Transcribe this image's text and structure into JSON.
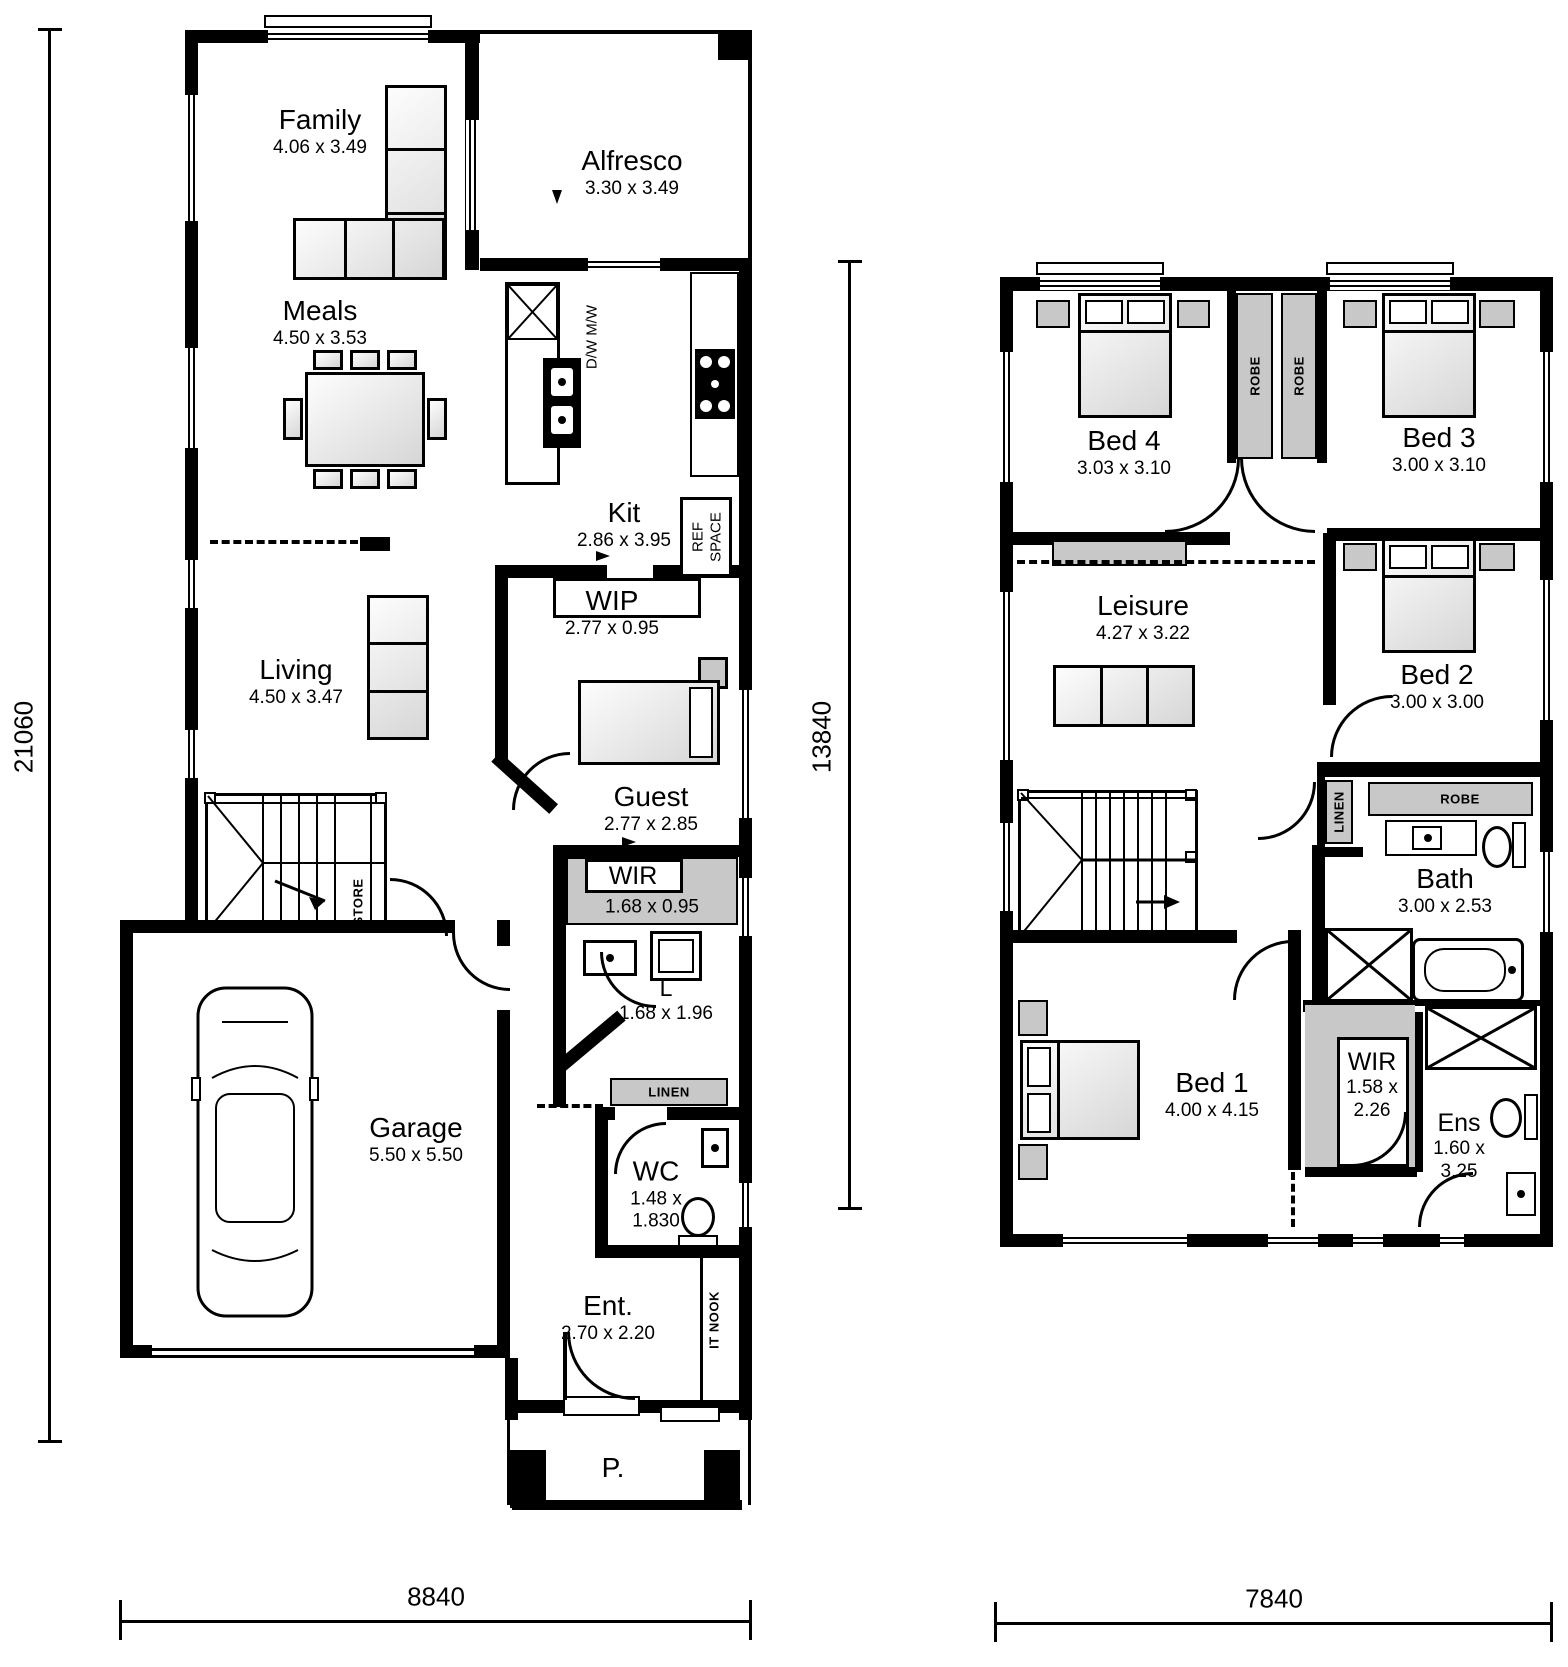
{
  "plan": {
    "gf": {
      "rooms": {
        "family": {
          "name": "Family",
          "dims": "4.06 x 3.49"
        },
        "alfresco": {
          "name": "Alfresco",
          "dims": "3.30 x 3.49"
        },
        "meals": {
          "name": "Meals",
          "dims": "4.50 x 3.53"
        },
        "kit": {
          "name": "Kit",
          "dims": "2.86 x 3.95"
        },
        "wip": {
          "name": "WIP",
          "dims": "2.77 x 0.95"
        },
        "living": {
          "name": "Living",
          "dims": "4.50 x 3.47"
        },
        "guest": {
          "name": "Guest",
          "dims": "2.77 x 2.85"
        },
        "wir": {
          "name": "WIR",
          "dims": "1.68 x 0.95"
        },
        "laundry": {
          "name": "L",
          "dims": "1.68 x 1.96"
        },
        "garage": {
          "name": "Garage",
          "dims": "5.50 x 5.50"
        },
        "wc": {
          "name": "WC",
          "dims1": "1.48 x",
          "dims2": "1.830"
        },
        "ent": {
          "name": "Ent.",
          "dims": "2.70 x 2.20"
        },
        "porch": {
          "name": "P."
        }
      },
      "labels": {
        "store": "STORE",
        "linen": "LINEN",
        "it_nook": "IT NOOK",
        "dw_mw": "D/W M/W",
        "ref": "REF",
        "space": "SPACE"
      },
      "dims": {
        "height": "21060",
        "width": "8840"
      }
    },
    "ff": {
      "rooms": {
        "bed4": {
          "name": "Bed 4",
          "dims": "3.03 x 3.10"
        },
        "bed3": {
          "name": "Bed 3",
          "dims": "3.00 x 3.10"
        },
        "bed2": {
          "name": "Bed 2",
          "dims": "3.00 x 3.00"
        },
        "leisure": {
          "name": "Leisure",
          "dims": "4.27 x 3.22"
        },
        "bath": {
          "name": "Bath",
          "dims": "3.00 x 2.53"
        },
        "bed1": {
          "name": "Bed 1",
          "dims": "4.00 x 4.15"
        },
        "wir": {
          "name": "WIR",
          "dims1": "1.58 x",
          "dims2": "2.26"
        },
        "ens": {
          "name": "Ens",
          "dims1": "1.60 x",
          "dims2": "3.25"
        }
      },
      "labels": {
        "robe1": "ROBE",
        "robe2": "ROBE",
        "robe3": "ROBE",
        "linen": "LINEN"
      },
      "dims": {
        "height": "13840",
        "width": "7840"
      }
    },
    "colors": {
      "wall": "#000000",
      "storage_fill": "#c8c8c8",
      "background": "#ffffff"
    }
  }
}
